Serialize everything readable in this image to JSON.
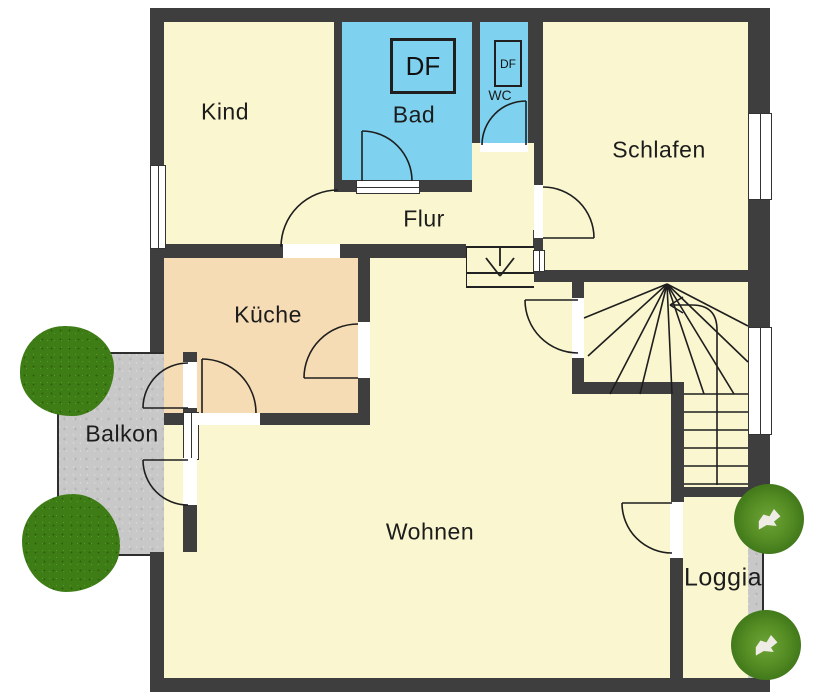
{
  "plan": {
    "rooms": {
      "kind": "Kind",
      "bad": "Bad",
      "wc": "WC",
      "schlafen": "Schlafen",
      "flur": "Flur",
      "kueche": "Küche",
      "wohnen": "Wohnen",
      "balkon": "Balkon",
      "loggia": "Loggia"
    },
    "annotations": {
      "df_bad": "DF",
      "df_wc": "DF"
    },
    "colors": {
      "wall": "#3e3e3e",
      "room_default": "#faf7d0",
      "wet_room": "#7ed2f0",
      "kitchen": "#f6dcb4",
      "outdoor_gray": "#c8c8c8",
      "tree_green": "#3e7d16"
    }
  }
}
